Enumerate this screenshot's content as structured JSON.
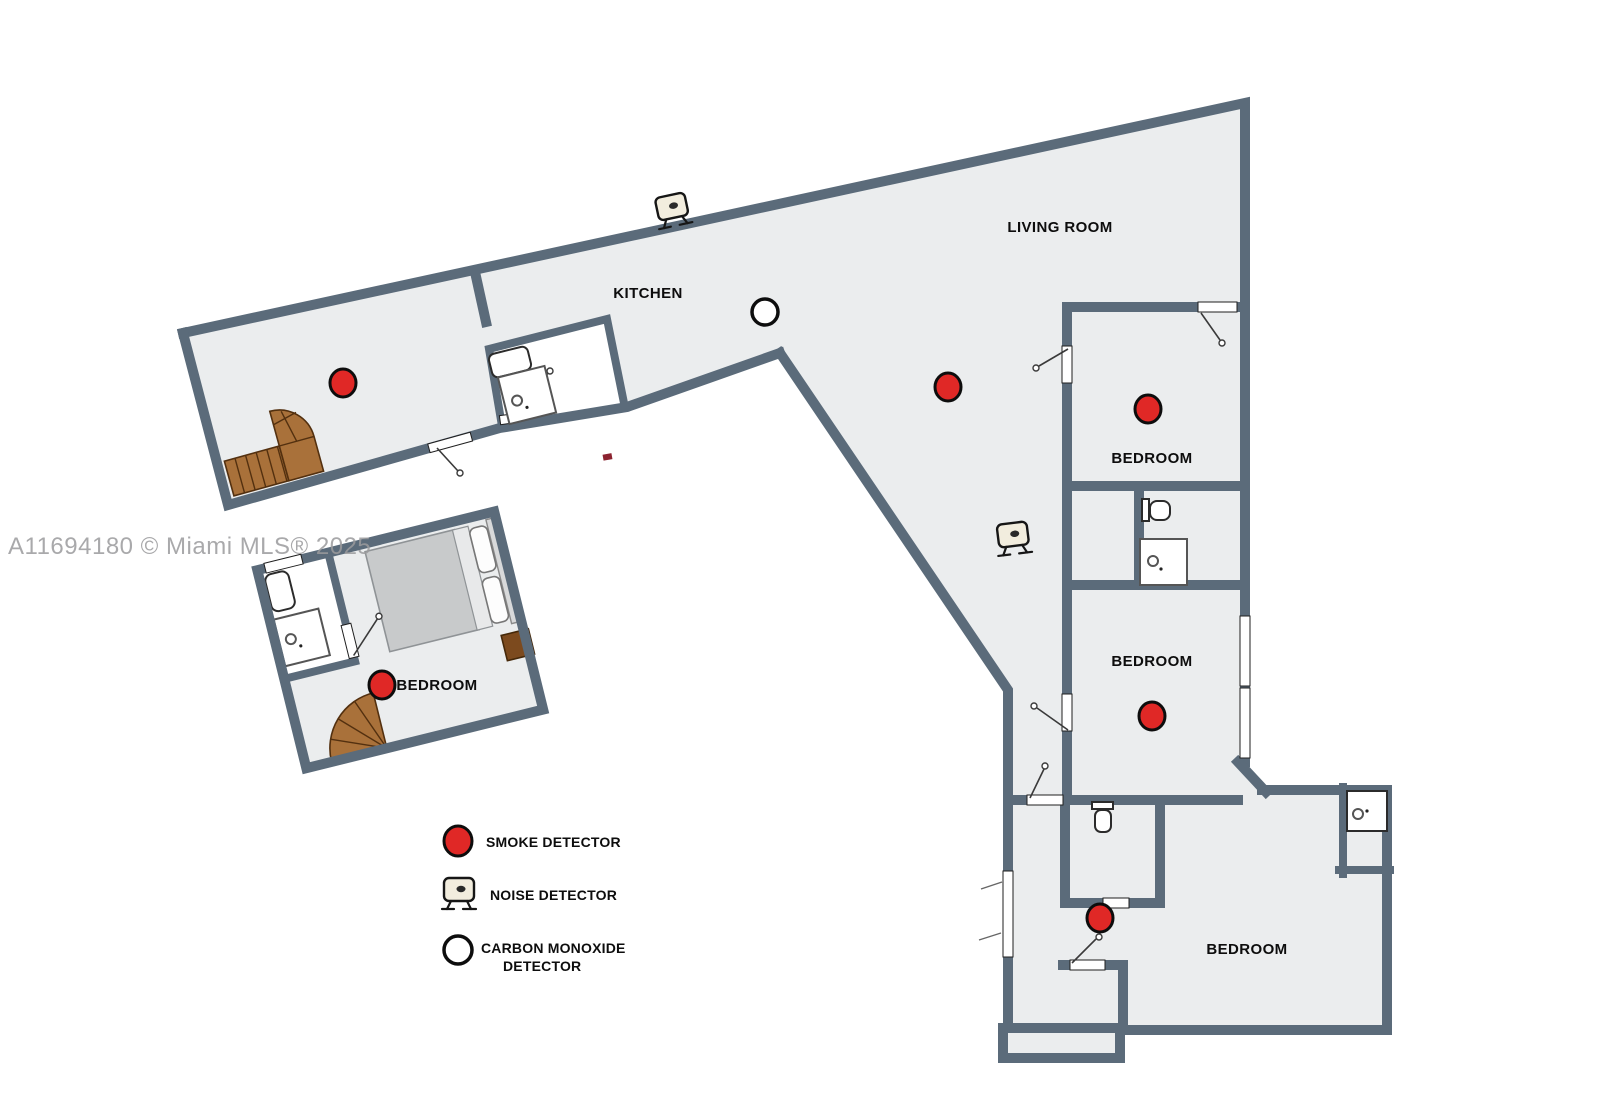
{
  "watermark": "A11694180 © Miami MLS® 2025",
  "rooms": {
    "kitchen": "KITCHEN",
    "living_room": "LIVING ROOM",
    "bedroom_top_right": "BEDROOM",
    "bedroom_mid_right": "BEDROOM",
    "bedroom_bottom_right": "BEDROOM",
    "bedroom_detached": "BEDROOM"
  },
  "legend": {
    "smoke_label": "SMOKE DETECTOR",
    "noise_label": "NOISE DETECTOR",
    "co_label_line1": "CARBON MONOXIDE",
    "co_label_line2": "DETECTOR"
  },
  "icons": {
    "smoke_detector": "red-circle-icon",
    "noise_detector": "monitor-device-icon",
    "carbon_monoxide_detector": "white-circle-icon"
  },
  "colors": {
    "wall": "#5b6b7a",
    "floor": "#ebedee",
    "smoke_red": "#e02826",
    "stairs_brown": "#a9713a",
    "watermark_gray": "#9b9b9d"
  }
}
